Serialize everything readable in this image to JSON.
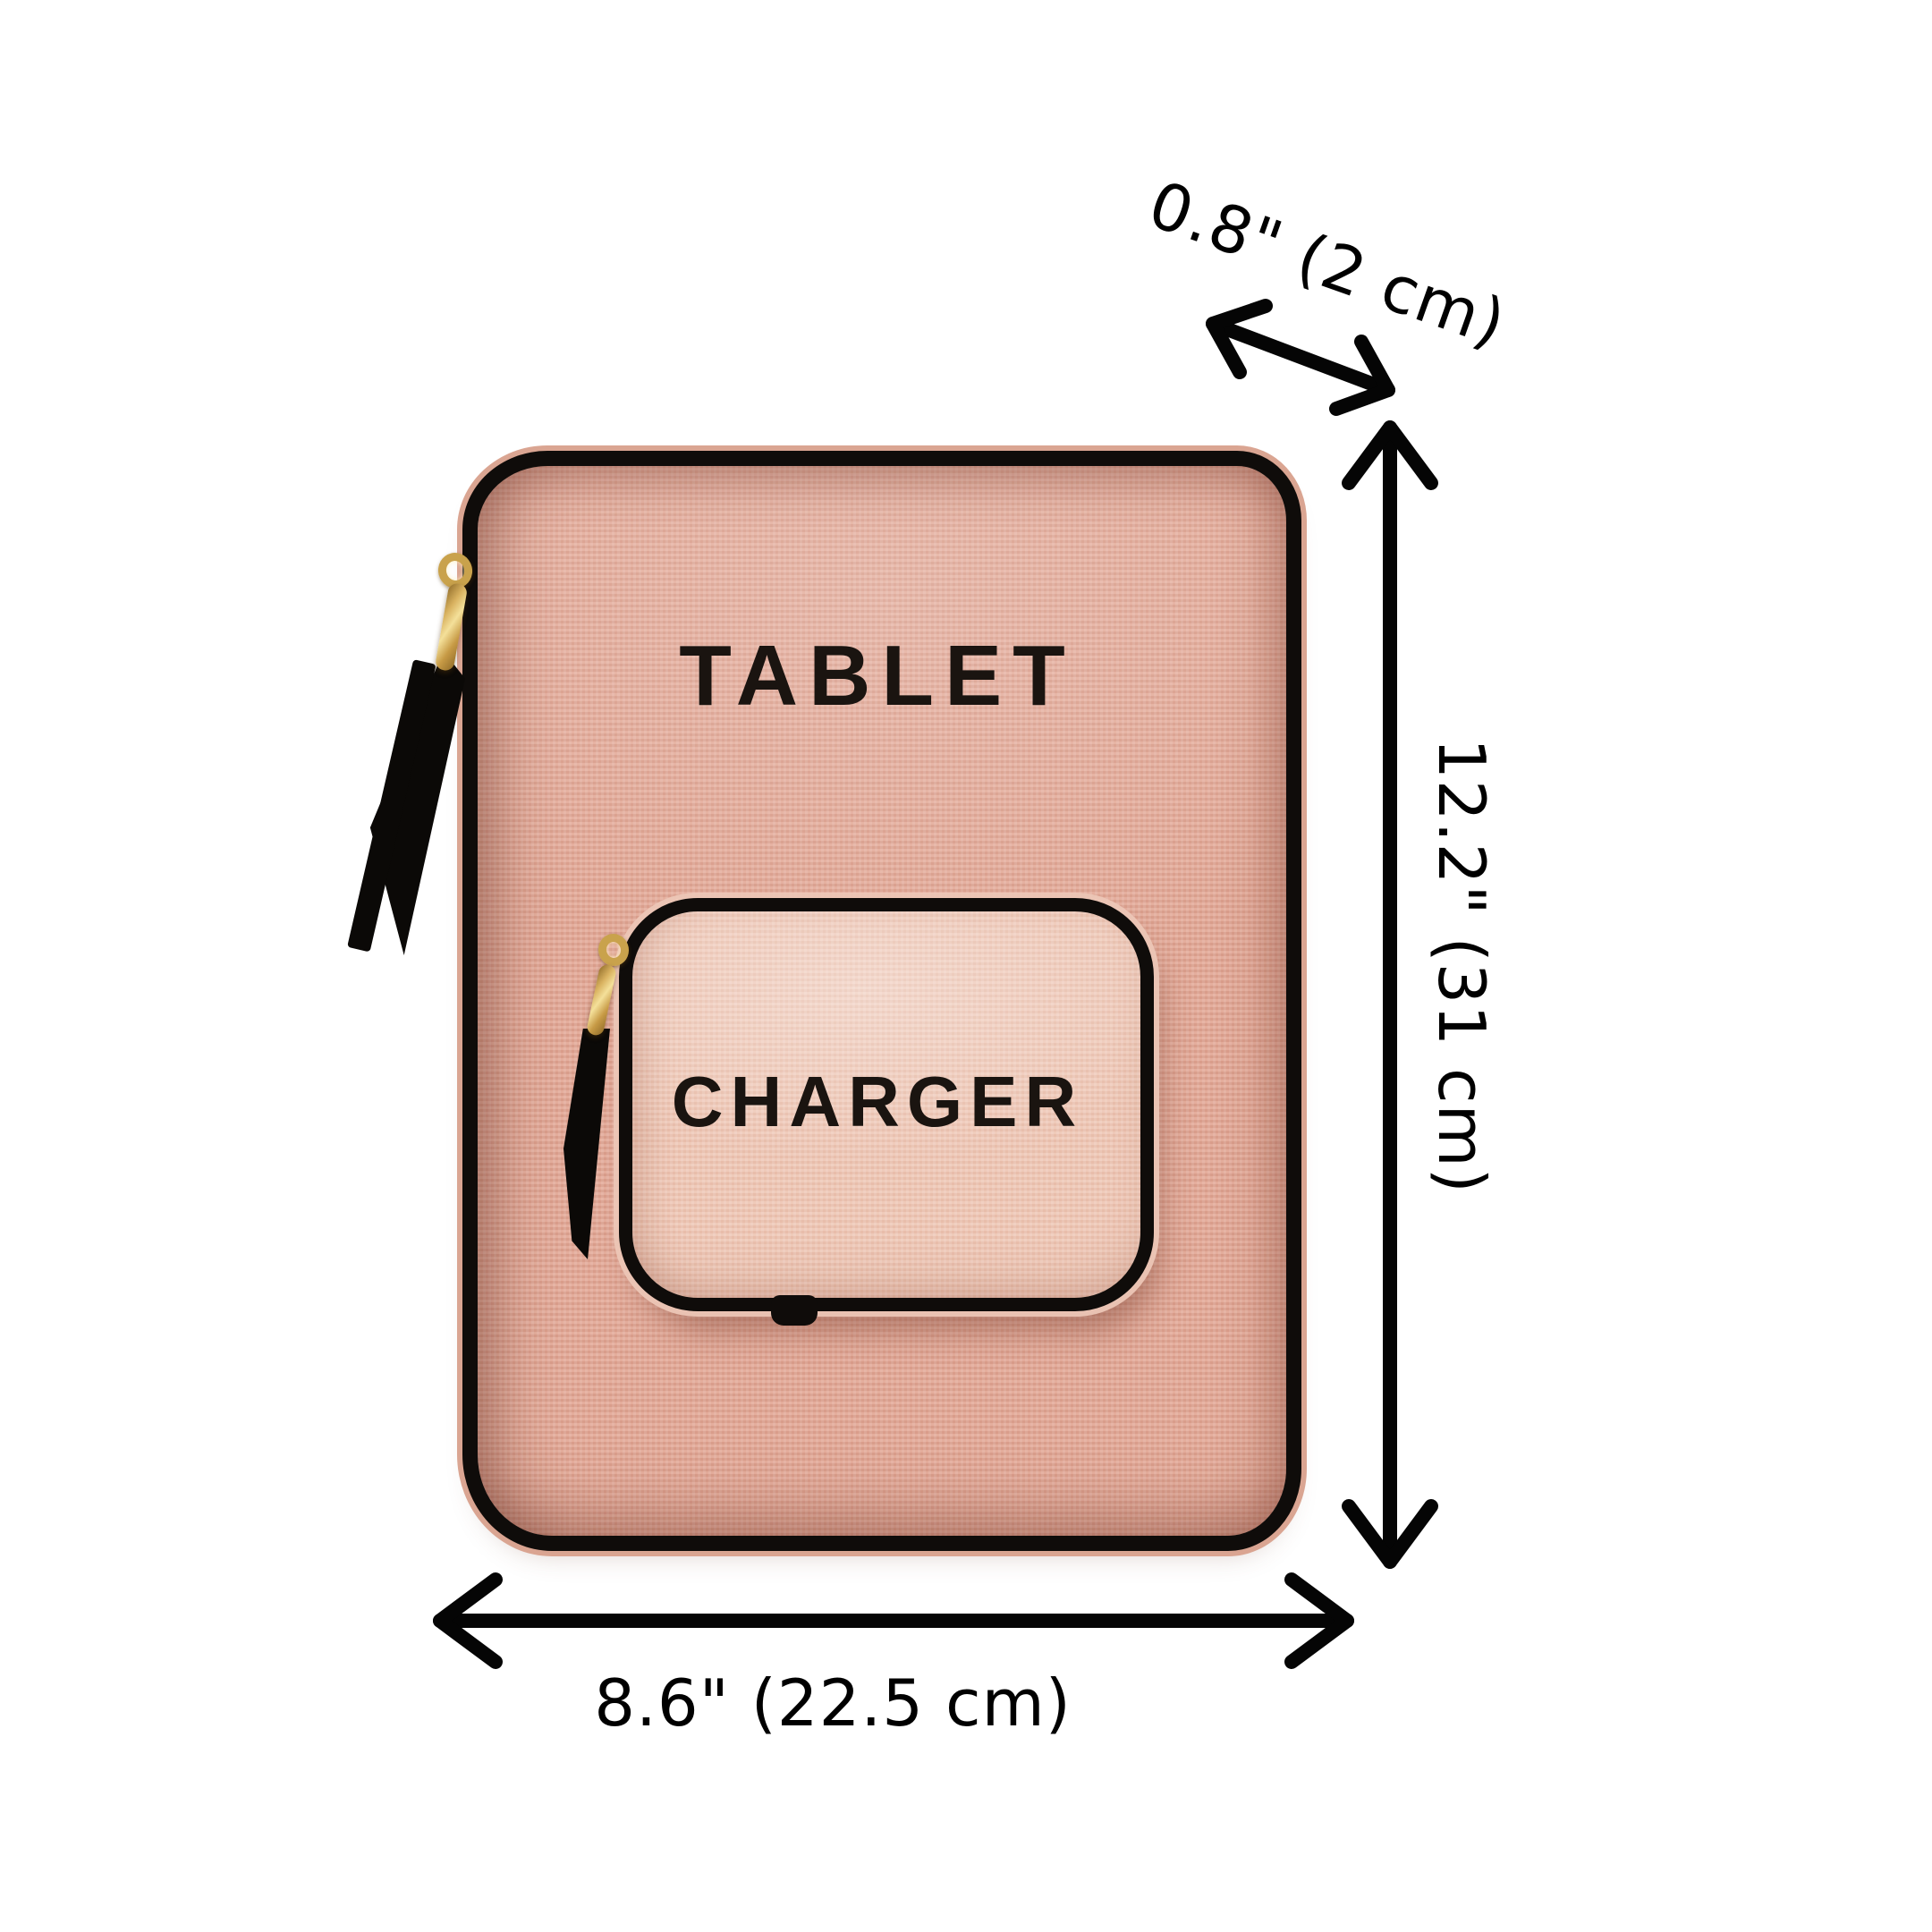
{
  "product": {
    "main_label": "TABLET",
    "pocket_label": "CHARGER"
  },
  "dimensions": {
    "depth": "0.8\" (2 cm)",
    "height": "12.2\" (31 cm)",
    "width": "8.6\" (22.5 cm)"
  },
  "icons": [
    "depth-arrow-icon",
    "height-arrow-icon",
    "width-arrow-icon",
    "tablet-zipper-pull-icon",
    "charger-zipper-pull-icon"
  ],
  "colors": {
    "background": "#ffffff",
    "case_pink": "#e2a795",
    "pocket_pink": "#eec5b3",
    "trim_black": "#0f0c0a",
    "zipper_gold": "#d9b260",
    "label_black": "#1a1410",
    "dimension_black": "#000000"
  }
}
